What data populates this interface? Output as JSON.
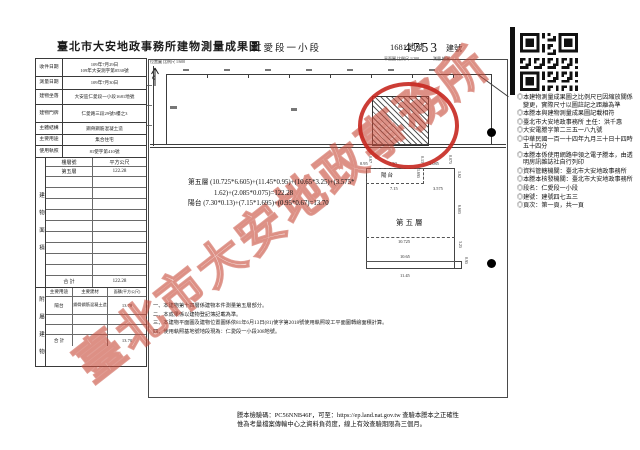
{
  "watermark": "臺北市大安地政事務所",
  "header": {
    "title": "臺北市大安地政事務所建物測量成果圖",
    "section": "仁愛段一小段",
    "land_no": "1681地號",
    "building_no": "4753",
    "building_no_suffix": "建號",
    "scale_left": "位置圖 比例尺 1/600",
    "scale_right": "平面圖 比例尺 1/200",
    "sign_labels": "測量 繪圖"
  },
  "info_table": {
    "rows": [
      {
        "label": "收件日期",
        "value": "109年7月29日",
        "value2": "109年大安測字第0530號"
      },
      {
        "label": "測量日期",
        "value": "109年7月30日",
        "value2": ""
      },
      {
        "label": "建物坐落",
        "value": "大安區仁愛段一小段1681地號",
        "value2": ""
      },
      {
        "label": "建物門牌",
        "value": "仁愛路三段29號5樓之3",
        "value2": ""
      },
      {
        "label": "主體結構",
        "value": "鋼骨鋼筋混凝土造",
        "value2": ""
      },
      {
        "label": "主要用途",
        "value": "集合住宅",
        "value2": ""
      },
      {
        "label": "使用執照",
        "value": "81使字第410號",
        "value2": ""
      }
    ]
  },
  "area_table": {
    "side_label": "建物面積",
    "header": [
      "樓層號",
      "平方公尺"
    ],
    "rows": [
      {
        "floor": "第五層",
        "area": "122.28"
      }
    ],
    "total_label": "合 計",
    "total": "122.28"
  },
  "annex_table": {
    "side_label": "附屬建物",
    "header": [
      "主要用途",
      "主要建材",
      "面積(平方公尺)"
    ],
    "rows": [
      {
        "use": "陽台",
        "material": "鋼骨鋼筋混凝土造",
        "area": "13.70"
      }
    ],
    "total_label": "合 計",
    "total": "13.70"
  },
  "drawing": {
    "formula_line1": "第五層 (10.725*6.605)+(11.45*0.95)+(10.65*3.25)+(3.575*",
    "formula_line2": "1.62)+(2.085*0.075)=122.28",
    "formula_line3": "陽台 (7.30*0.13)+(7.15*1.695)+(0.95*0.67)=13.70",
    "floor_label": "第五層",
    "balcony_label": "陽台",
    "dims": [
      {
        "t": "0.95"
      },
      {
        "t": "0.67"
      },
      {
        "t": "7.30"
      },
      {
        "t": "0.13"
      },
      {
        "t": "2.085"
      },
      {
        "t": "0.075"
      },
      {
        "t": "1.695"
      },
      {
        "t": "7.15"
      },
      {
        "t": "3.575"
      },
      {
        "t": "1.62"
      },
      {
        "t": "6.605"
      },
      {
        "t": "3.25"
      },
      {
        "t": "10.725"
      },
      {
        "t": "10.65"
      },
      {
        "t": "0.95"
      },
      {
        "t": "11.45"
      }
    ]
  },
  "notes": [
    "一、本建物第十四層係建物本件測量第五層部分。",
    "二、本成果係以建物登記簿記載為準。",
    "三、本建物平面圖及建物位置圖係依81年6月13日(81)使字第2018號使用執照竣工平面圖轉繪面積計算。",
    "四、使用執照基地號地段現為：仁愛段一小段308地號。"
  ],
  "right_notes": [
    "◎本建物測量成果圖之比例尺已因縮放關係變更，實際尺寸以圖註記之距離為準",
    "◎本謄本與建物測量成果圖記載相符",
    "◎臺北市大安地政事務所 主任：洪千惠",
    "◎大安電謄字第二三五一八九號",
    "◎中華民國一百一十四年九月三十日十四時五十四分",
    "◎本謄本係使用網路申領之電子謄本，由透明房訊雜誌社自行列印",
    "◎資料管轄機關：臺北市大安地政事務所",
    "◎本謄本核發機關：臺北市大安地政事務所",
    "◎段名：仁愛段一小段",
    "◎建號：建號四七五三",
    "◎頁次：第一頁，共一頁"
  ],
  "footer": {
    "line1": "謄本檢驗碼：PC56NNB46F，可至：https://ep.land.nat.gov.tw 查驗本謄本之正確性",
    "line2": "惟為考量檔案傳輸中心之資料負荷度，線上有效查驗期限為三個月。"
  }
}
